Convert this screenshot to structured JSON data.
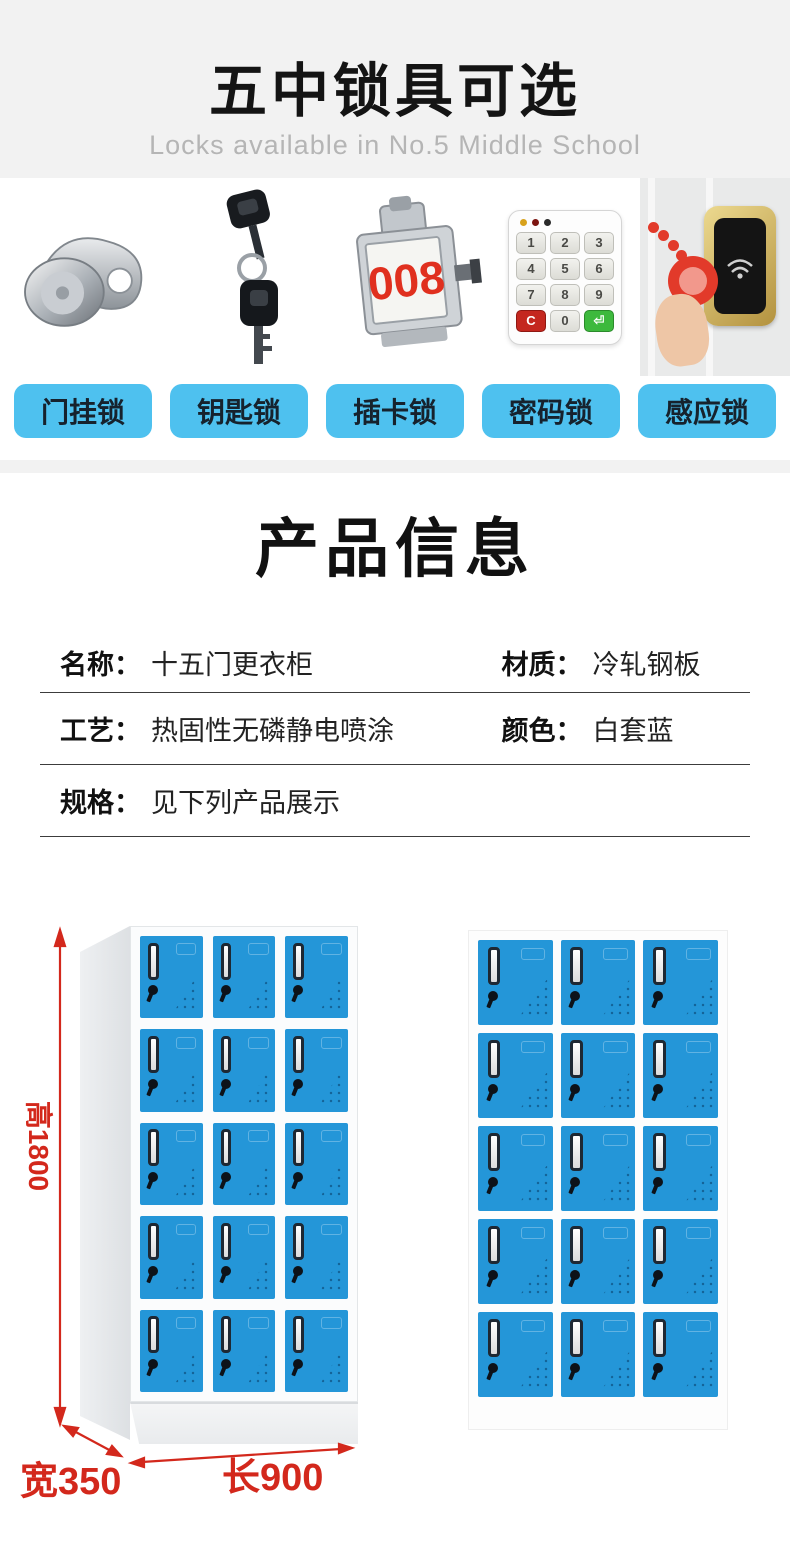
{
  "colors": {
    "header_gray": "#f2f2f2",
    "subtitle_gray": "#b5b5b5",
    "button_blue": "#4ec1ef",
    "door_blue": "#2496d8",
    "dimension_red": "#d3281c"
  },
  "header": {
    "title": "五中锁具可选",
    "subtitle": "Locks available in No.5 Middle School"
  },
  "locks": {
    "items": [
      {
        "label": "门挂锁",
        "icon": "cam-lock"
      },
      {
        "label": "钥匙锁",
        "icon": "keys"
      },
      {
        "label": "插卡锁",
        "icon": "card-lock",
        "number": "008"
      },
      {
        "label": "密码锁",
        "icon": "keypad",
        "keys": [
          "1",
          "2",
          "3",
          "4",
          "5",
          "6",
          "7",
          "8",
          "9",
          "C",
          "0",
          "⏎"
        ]
      },
      {
        "label": "感应锁",
        "icon": "induction-lock"
      }
    ]
  },
  "product_info": {
    "title": "产品信息",
    "rows": [
      [
        {
          "label": "名称：",
          "value": "十五门更衣柜"
        },
        {
          "label": "材质：",
          "value": "冷轧钢板"
        }
      ],
      [
        {
          "label": "工艺：",
          "value": "热固性无磷静电喷涂"
        },
        {
          "label": "颜色：",
          "value": "白套蓝"
        }
      ],
      [
        {
          "label": "规格：",
          "value": "见下列产品展示"
        }
      ]
    ]
  },
  "display": {
    "dimensions": {
      "height": "高1800",
      "width": "宽350",
      "length": "长900"
    },
    "lockers": [
      {
        "name": "locker-3d-view",
        "rows": 5,
        "cols": 3
      },
      {
        "name": "locker-front-view",
        "rows": 5,
        "cols": 3
      }
    ]
  }
}
